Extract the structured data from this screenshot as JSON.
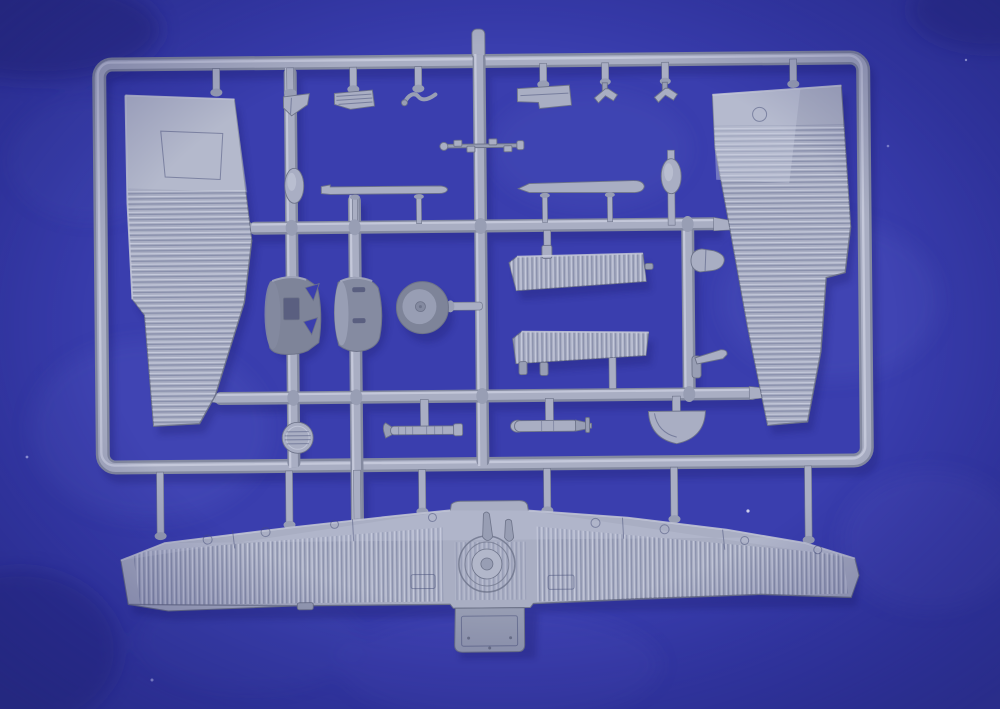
{
  "scene": {
    "type": "photograph",
    "subject": "Grey injection-moulded plastic model aircraft sprue (parts tree) of a corrugated-skin monoplane kit, photographed on a blue cloth background",
    "visible_text": "none",
    "lighting": "soft light from upper left, diffuse shadows cast down-right onto the blue cloth"
  },
  "colors": {
    "bg": "#3a3eae",
    "bg-light": "#5a60c8",
    "bg-dark": "#24277e",
    "plastic": "#a9aec3",
    "plastic-light": "#c9cdde",
    "plastic-mid": "#989eb4",
    "plastic-dark": "#848aa0",
    "plastic-deep": "#6d7389",
    "cowl": "#7e8499",
    "cowl2": "#858ba1",
    "hole": "#5a5f80",
    "shadow": "#1b1e6e"
  },
  "sprue": {
    "frame": "rounded rectangular outer frame with top, bottom, left and right rails",
    "runners": [
      "left vertical runner",
      "second vertical runner",
      "center vertical runner",
      "right vertical runner",
      "upper horizontal cross-runner",
      "lower horizontal cross-runner"
    ],
    "parts": [
      {
        "name": "left-wing-upper-panel",
        "desc": "large tapered corrugated upper wing half, root at top, smooth root panel",
        "location": "upper left"
      },
      {
        "name": "right-wing-upper-panel",
        "desc": "large tapered corrugated upper wing half with aileron step on outer edge",
        "location": "upper right"
      },
      {
        "name": "lower-wing-one-piece",
        "desc": "full-span corrugated one-piece lower wing with turret ring, two teardrop fairings and ventral gondola",
        "location": "bottom"
      },
      {
        "name": "angled-bracket",
        "desc": "small angled bulkhead bracket",
        "location": "top row left"
      },
      {
        "name": "louvered-seat-panel",
        "desc": "small louvered rectangular panel",
        "location": "top row"
      },
      {
        "name": "s-shaped-control-linkage",
        "desc": "thin S-curved control linkage",
        "location": "top row"
      },
      {
        "name": "notched-floor-plate",
        "desc": "rectangular cockpit floor plate with notch",
        "location": "top row right"
      },
      {
        "name": "anchor-fitting-a",
        "desc": "small anchor / arrow shaped fitting",
        "location": "top row right"
      },
      {
        "name": "anchor-fitting-b",
        "desc": "small anchor / arrow shaped fitting",
        "location": "top row right"
      },
      {
        "name": "crankshaft-detail-rod",
        "desc": "thin detailed shaft crossing the center runner",
        "location": "upper center"
      },
      {
        "name": "strut-fairing-left",
        "desc": "long flat strut fairing strip",
        "location": "mid left"
      },
      {
        "name": "strut-fairing-right",
        "desc": "long flat strut fairing strip",
        "location": "mid right"
      },
      {
        "name": "oval-wheel-fairing-left",
        "desc": "small oval fairing",
        "location": "mid left"
      },
      {
        "name": "oval-wheel-fairing-right",
        "desc": "small oval fairing",
        "location": "mid right"
      },
      {
        "name": "engine-cowling-notched",
        "desc": "dark cylindrical engine cowling with V-notches and rectangular opening",
        "location": "middle"
      },
      {
        "name": "engine-cowling-slotted",
        "desc": "dark cylindrical engine cowling with two slots",
        "location": "middle"
      },
      {
        "name": "main-wheel",
        "desc": "round main wheel with hub disc",
        "location": "middle"
      },
      {
        "name": "tailplane-corrugated-upper",
        "desc": "corrugated tailplane half",
        "location": "center right"
      },
      {
        "name": "tailplane-corrugated-lower",
        "desc": "corrugated tailplane half",
        "location": "center right, lower"
      },
      {
        "name": "bullet-fairing",
        "desc": "small bullet-shaped fairing",
        "location": "right of center"
      },
      {
        "name": "propeller-hub-blade",
        "desc": "small hub with single blade",
        "location": "right of center, lower"
      },
      {
        "name": "ribbed-gun-barrel",
        "desc": "ribbed machine-gun barrel with bent tip",
        "location": "lower middle left"
      },
      {
        "name": "small-bomb",
        "desc": "small bomb with tail fin",
        "location": "lower middle"
      },
      {
        "name": "half-round-cowl-ring",
        "desc": "half-round cowl piece, flat side up",
        "location": "lower middle right"
      },
      {
        "name": "louvered-radiator-disc",
        "desc": "round louvered radiator disc",
        "location": "lower left runner"
      },
      {
        "name": "sprue-top-stub",
        "desc": "short moulding stub above top rail",
        "location": "top center"
      }
    ]
  }
}
